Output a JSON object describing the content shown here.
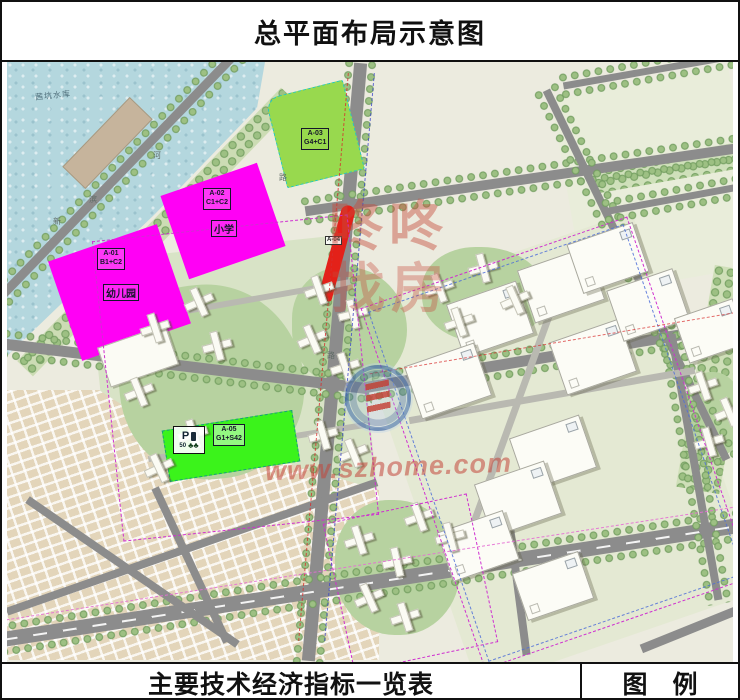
{
  "title": "总平面布局示意图",
  "footer": {
    "indicators_title": "主要技术经济指标一览表",
    "legend_title": "图　例"
  },
  "map": {
    "water_label": "茜坑水库",
    "road_chars": [
      "河",
      "滨",
      "新",
      "路",
      "路"
    ],
    "parcels": {
      "a01": {
        "code": "A-01",
        "use": "B1+C2",
        "sub": "幼儿园"
      },
      "a02": {
        "code": "A-02",
        "use": "C1+C2",
        "sub": "小学"
      },
      "a03": {
        "code": "A-03",
        "use": "G4+C1"
      },
      "a04": {
        "code": "A-04"
      },
      "a05": {
        "code": "A-05",
        "use": "G1+S42"
      }
    },
    "parking_sign": {
      "letter": "P",
      "count": "50",
      "tree_icons": "♣♣"
    },
    "watermark": {
      "char1": "咚",
      "char2": "咚",
      "char3": "找",
      "char4": "房",
      "url": "www.szhome.com"
    }
  },
  "colors": {
    "commercial_magenta": "#ff00f5",
    "green_a03": "#98d94e",
    "green_a05": "#3bf31b",
    "highlight_red": "#e32119",
    "water_blue": "#b4d7de",
    "road_gray": "#8c8c8c"
  }
}
